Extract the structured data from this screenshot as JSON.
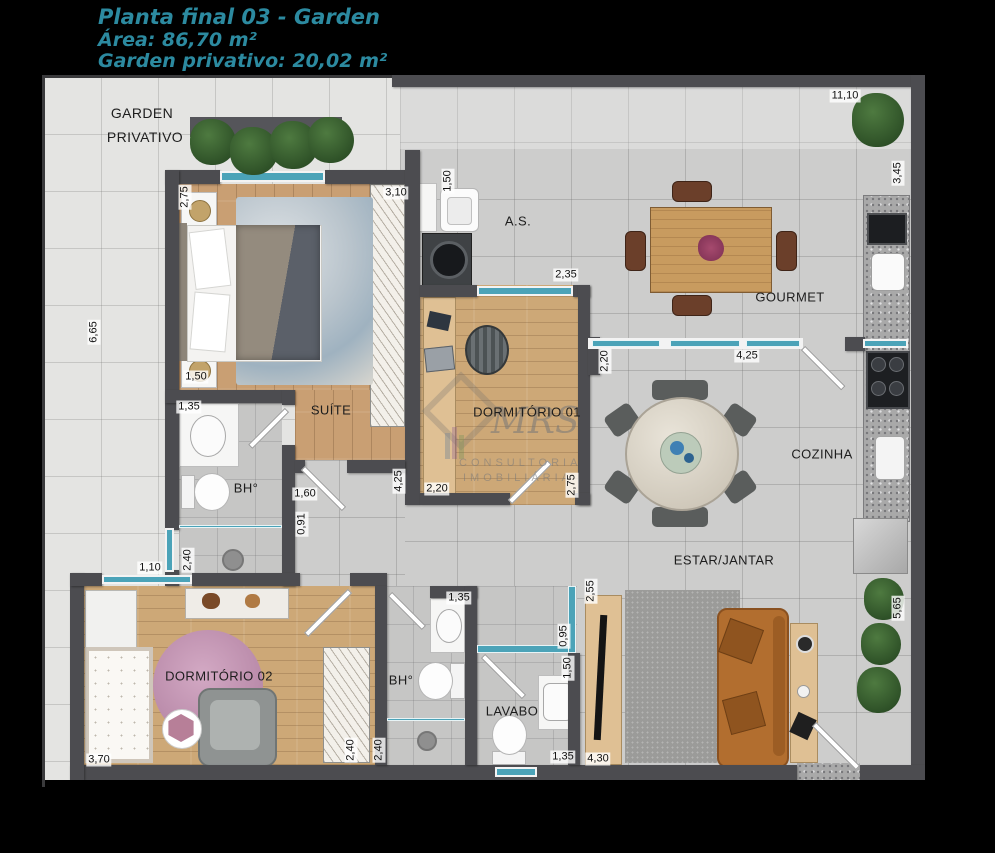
{
  "title": {
    "line1": "Planta final 03 - Garden",
    "line2": "Área: 86,70 m²",
    "line3": "Garden privativo: 20,02 m²"
  },
  "watermark": {
    "logo": "MRS",
    "line1": "CONSULTORIA",
    "line2": "IMOBILIÁRIA"
  },
  "rooms": {
    "garden_line1": "GARDEN",
    "garden_line2": "PRIVATIVO",
    "suite": "SUÍTE",
    "bathroom1": "BH°",
    "dorm1": "DORMITÓRIO 01",
    "service": "A.S.",
    "gourmet": "GOURMET",
    "kitchen": "COZINHA",
    "living": "ESTAR/JANTAR",
    "dorm2": "DORMITÓRIO 02",
    "bathroom2": "BH°",
    "lavabo": "LAVABO"
  },
  "dimensions": [
    "11,10",
    "3,45",
    "6,65",
    "2,75",
    "3,10",
    "1,50",
    "1,50",
    "2,35",
    "2,20",
    "4,25",
    "4,25",
    "2,20",
    "2,75",
    "1,35",
    "1,60",
    "0,91",
    "2,40",
    "1,10",
    "3,70",
    "2,40",
    "2,40",
    "1,35",
    "2,55",
    "0,95",
    "1,50",
    "1,35",
    "4,30",
    "5,65"
  ],
  "colors": {
    "accent_title": "#2c8aa0",
    "wall": "#4c4c50",
    "window": "#4ba3b8",
    "wood_floor": "#c99f73",
    "unit_tile": "#cdcdcc",
    "garden_tile": "#e4e4e2",
    "sofa": "#b26e2f",
    "rug_pink": "#c394b4"
  }
}
